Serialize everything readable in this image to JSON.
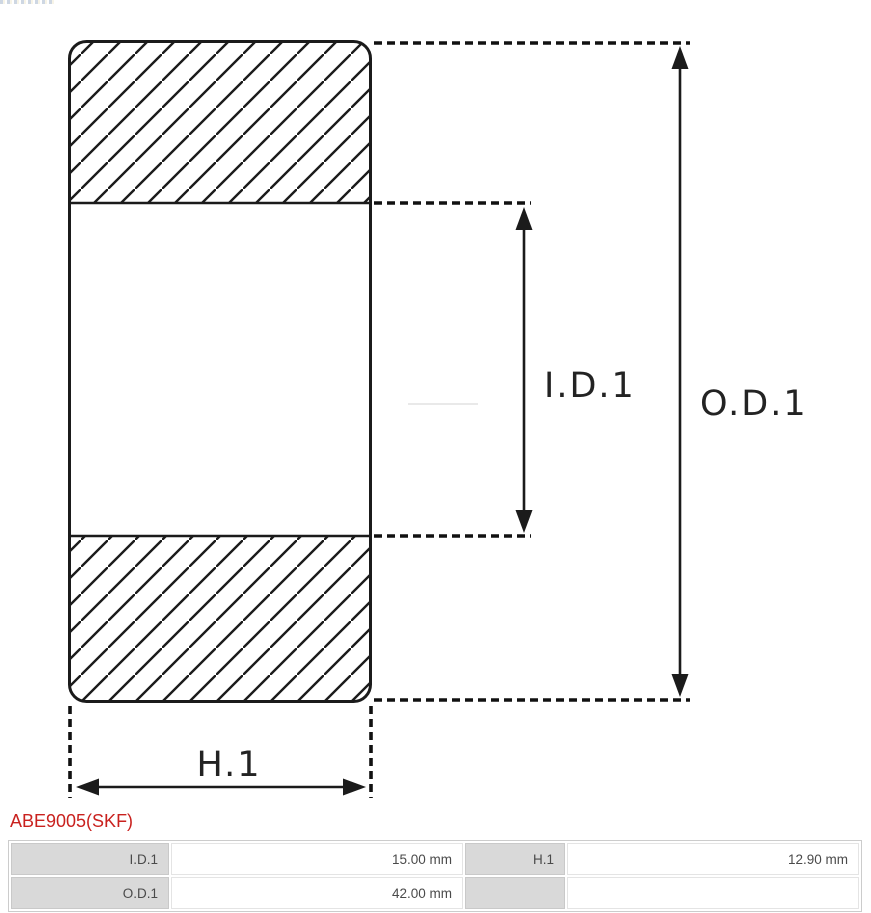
{
  "colors": {
    "line": "#1b1b1b",
    "accent_red": "#c9211e",
    "table_label_bg": "#d9d9d9",
    "table_border": "#cccccc"
  },
  "diagram": {
    "labels": {
      "inner_diameter": "I.D.1",
      "outer_diameter": "O.D.1",
      "height": "H.1"
    }
  },
  "title": {
    "part_number": "ABE9005(SKF)"
  },
  "table": {
    "rows": [
      [
        {
          "label": "I.D.1",
          "value": "15.00 mm"
        },
        {
          "label": "H.1",
          "value": "12.90 mm"
        }
      ],
      [
        {
          "label": "O.D.1",
          "value": "42.00 mm"
        },
        {
          "label": "",
          "value": ""
        }
      ]
    ]
  }
}
